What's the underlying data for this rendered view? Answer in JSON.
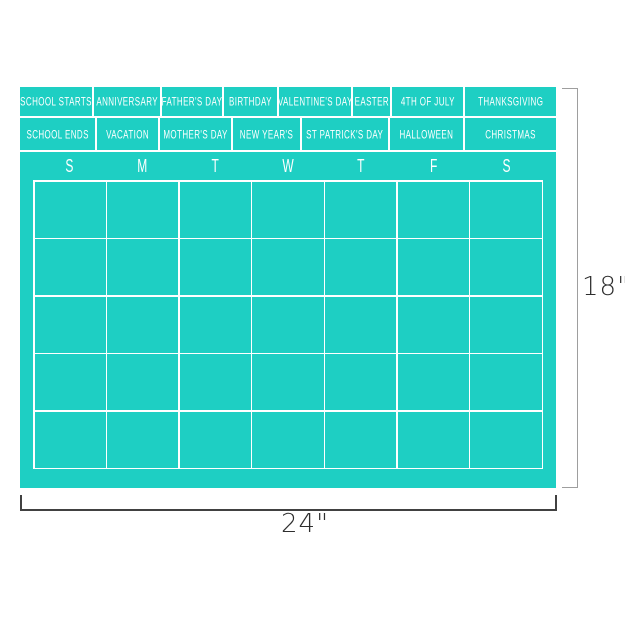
{
  "decal": {
    "background_color": "#1ecfc3",
    "grid_line_color": "#ffffff",
    "text_color": "#ffffff",
    "holiday_row_1": [
      "SCHOOL STARTS",
      "ANNIVERSARY",
      "FATHER'S DAY",
      "BIRTHDAY",
      "VALENTINE'S DAY",
      "EASTER",
      "4TH OF JULY",
      "THANKSGIVING"
    ],
    "holiday_row_2": [
      "SCHOOL ENDS",
      "VACATION",
      "MOTHER'S DAY",
      "NEW YEAR'S",
      "ST PATRICK'S DAY",
      "HALLOWEEN",
      "CHRISTMAS"
    ],
    "day_headers": [
      "S",
      "M",
      "T",
      "W",
      "T",
      "F",
      "S"
    ],
    "grid": {
      "columns": 7,
      "rows": 5
    }
  },
  "annotations": {
    "height_label": "18\"",
    "width_label": "24\"",
    "height_line_color": "#9e9e9e",
    "width_line_color": "#414141",
    "label_color": "#2e2e2e"
  }
}
